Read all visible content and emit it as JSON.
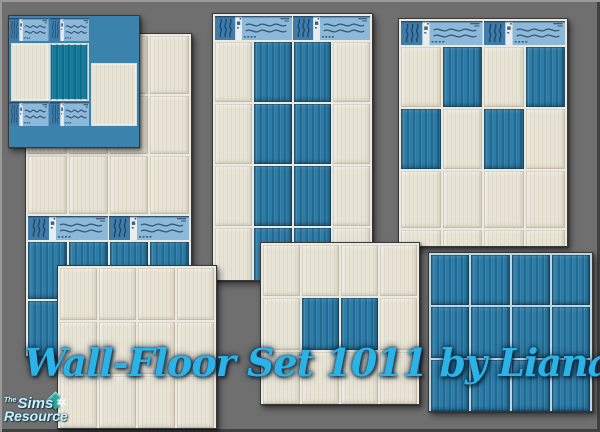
{
  "caption": {
    "text": "Wall-Floor Set 1011 by Lianaa",
    "color": "#29b3e6"
  },
  "logo": {
    "the": "The",
    "sims": "Sims",
    "resource": "Resource",
    "plumbob_color": "#27a59c"
  },
  "colors": {
    "background": "#6f6f6f",
    "cream": "#e7e3d5",
    "blue": "#2d7ca7",
    "teal": "#137c9c",
    "grout_cream": "#eceadf",
    "grout_blue": "#bcd6e2",
    "decor_light": "#8cb9d9",
    "decor_mid": "#3e7dab",
    "decor_wave": "#1e3d57",
    "decor_white": "#e8edef",
    "corner_bg": "#3b83ad"
  },
  "legend": {
    "C": "cream-tile",
    "B": "blue-tile",
    "T": "teal-tile",
    "decor": "wave-border-tile"
  },
  "panels": [
    {
      "name": "corner-border-sample",
      "x": 8,
      "y": 15,
      "w": 132,
      "h": 133,
      "z": 3,
      "type": "blocks",
      "bg": "corner_bg",
      "blocks": [
        {
          "f": "D2",
          "x": 0,
          "y": 2,
          "w": 80,
          "h": 23
        },
        {
          "f": "C",
          "x": 3,
          "y": 28,
          "w": 36,
          "h": 56
        },
        {
          "f": "T",
          "x": 41,
          "y": 28,
          "w": 38,
          "h": 56
        },
        {
          "f": "C",
          "x": 83,
          "y": 48,
          "w": 44,
          "h": 61
        },
        {
          "f": "D2",
          "x": 0,
          "y": 86,
          "w": 80,
          "h": 24
        }
      ]
    },
    {
      "name": "wall-cream-over-blue-border",
      "x": 25,
      "y": 33,
      "w": 167,
      "h": 324,
      "z": 1,
      "type": "grid",
      "grout": "grout_cream",
      "rows": [
        {
          "cells": "CCCC",
          "h": 58
        },
        {
          "cells": "CCCC",
          "h": 58
        },
        {
          "cells": "CCCC",
          "h": 58
        },
        {
          "decor": 2,
          "h": 24
        },
        {
          "cells": "BBBB",
          "h": 57
        },
        {
          "cells": "BBBB",
          "h": 57
        }
      ]
    },
    {
      "name": "wall-blue-stripe",
      "x": 212,
      "y": 13,
      "w": 161,
      "h": 268,
      "z": 1,
      "type": "grid",
      "grout": "grout_cream",
      "rows": [
        {
          "decor": 2,
          "h": 24
        },
        {
          "cells": "CBBC",
          "h": 60
        },
        {
          "cells": "CBBC",
          "h": 60
        },
        {
          "cells": "CBBC",
          "h": 60
        },
        {
          "cells": "CBBC",
          "h": 60
        },
        {
          "cells": "CBBC",
          "h": 60
        }
      ]
    },
    {
      "name": "wall-checkerboard",
      "x": 398,
      "y": 18,
      "w": 170,
      "h": 229,
      "z": 1,
      "type": "grid",
      "grout": "grout_cream",
      "rows": [
        {
          "decor": 2,
          "h": 24
        },
        {
          "cells": "CBCB",
          "h": 60
        },
        {
          "cells": "BCBC",
          "h": 60
        },
        {
          "cells": "CCCC",
          "h": 57
        },
        {
          "cells": "CCCC",
          "h": 57
        }
      ]
    },
    {
      "name": "floor-cream",
      "x": 57,
      "y": 265,
      "w": 160,
      "h": 164,
      "z": 2,
      "type": "grid",
      "grout": "grout_cream",
      "rows": [
        {
          "cells": "CCCC",
          "h": 52
        },
        {
          "cells": "CCCC",
          "h": 52
        },
        {
          "cells": "CCCC",
          "h": 52
        }
      ]
    },
    {
      "name": "floor-blue-inset",
      "x": 260,
      "y": 242,
      "w": 160,
      "h": 163,
      "z": 2,
      "type": "grid",
      "grout": "grout_cream",
      "rows": [
        {
          "cells": "CCCC",
          "h": 51
        },
        {
          "cells": "CBBC",
          "h": 52
        },
        {
          "cells": "CCCC",
          "h": 52
        }
      ]
    },
    {
      "name": "floor-blue",
      "x": 428,
      "y": 252,
      "w": 165,
      "h": 160,
      "z": 2,
      "type": "grid",
      "grout": "grout_blue",
      "rows": [
        {
          "cells": "BBBB",
          "h": 50
        },
        {
          "cells": "BBBB",
          "h": 51
        },
        {
          "cells": "BBBB",
          "h": 51
        }
      ]
    }
  ]
}
